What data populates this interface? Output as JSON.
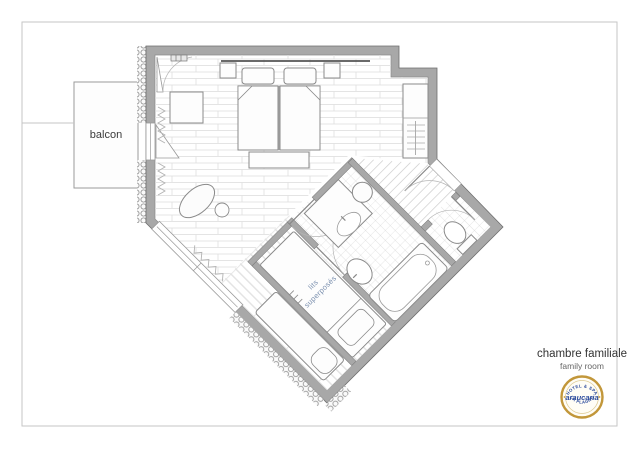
{
  "plan": {
    "balcony_label": "balcon",
    "bunk_room_label": {
      "line1": "lits",
      "line2": "superposés"
    }
  },
  "caption": {
    "title": "chambre familiale",
    "subtitle": "family room"
  },
  "logo": {
    "arc_top": "HOTEL & SPA",
    "name": "araucaria",
    "arc_bottom": "LA PLAGNE"
  },
  "colors": {
    "wall_gray": "#a8a8a8",
    "bunk_text_blue": "#7a8fae",
    "logo_gold": "#c2973a",
    "logo_blue": "#2b4a9b"
  }
}
